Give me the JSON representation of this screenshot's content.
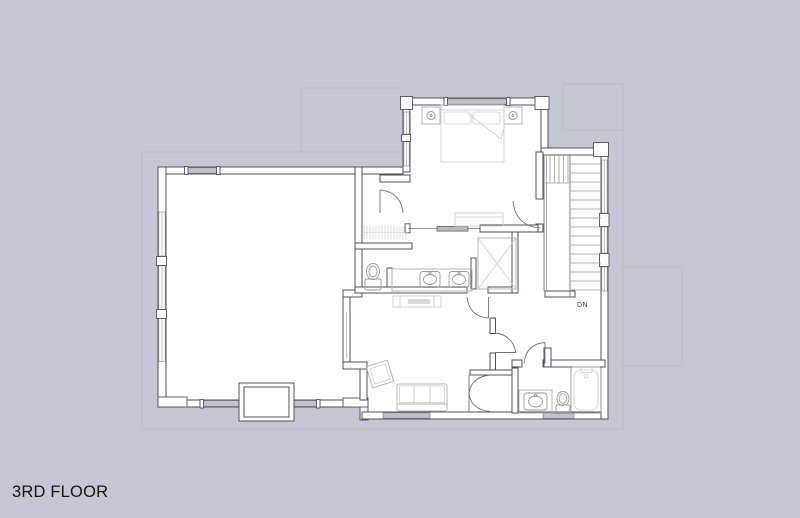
{
  "plan": {
    "floor_label": "3RD FLOOR",
    "stairs_label": "DN",
    "fixtures": [
      "double-bed",
      "nightstand-left",
      "nightstand-right",
      "closet-hanging-rods",
      "toilet-master-bath",
      "double-vanity-sinks",
      "shower",
      "pocket-door",
      "dresser",
      "fireplace",
      "armchair",
      "sofa",
      "bench",
      "bifold-closet-doors",
      "vanity-sink",
      "toilet",
      "bathtub",
      "staircase-down"
    ]
  },
  "palette": {
    "background": "#c6c7d5",
    "wall_stroke": "#50505a",
    "wall_fill": "#ffffff",
    "fixture_line": "#b3b3bc",
    "light_line": "#cbcbd3",
    "stair_line": "#9a9aa2",
    "window_fill": "#c2c2ca",
    "roof_line": "#babbc9",
    "text_color": "#141414"
  }
}
